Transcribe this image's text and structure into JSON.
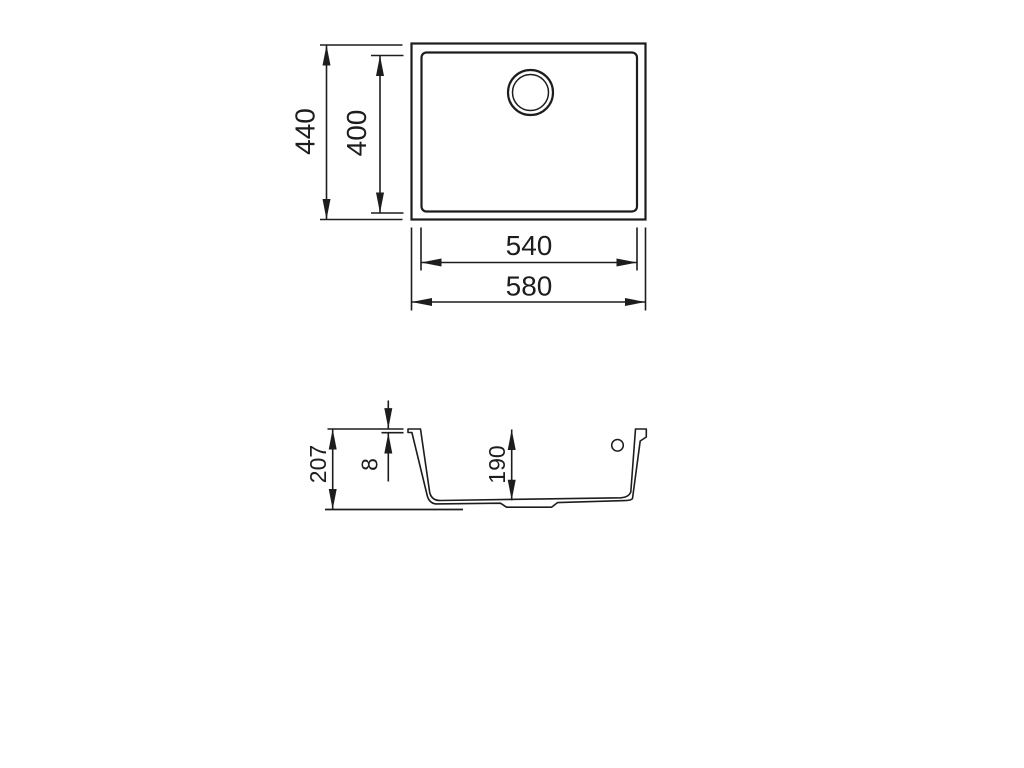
{
  "drawing": {
    "views": {
      "top_view_name": "top view",
      "section_view_name": "section view"
    },
    "dims": {
      "outer_height": "440",
      "bowl_height": "400",
      "bowl_width": "540",
      "outer_width": "580",
      "total_depth": "207",
      "rim_thickness": "8",
      "bowl_depth": "190"
    },
    "colors": {
      "line": "#1d1d1d",
      "background": "#ffffff"
    }
  }
}
